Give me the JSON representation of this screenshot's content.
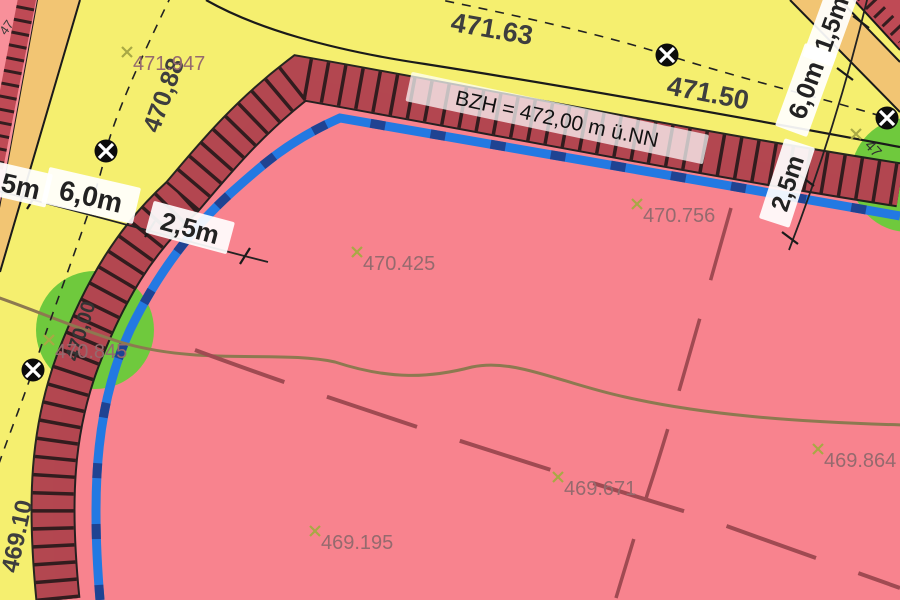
{
  "map": {
    "reference_height": "BZH = 472,00 m ü.NN",
    "road_elevation_labels": {
      "top_1": "471.63",
      "top_2": "471.50",
      "left_1": "470,88",
      "left_2": "469.10"
    },
    "contour_labels": {
      "contour_470": "470,00"
    },
    "partial_labels": {
      "top_left_corner": "47",
      "right_tree": "47"
    },
    "dimension_labels": {
      "left_15": "1,5m",
      "left_60": "6,0m",
      "left_25": "2,5m",
      "right_15": "1,5m",
      "right_60": "6,0m",
      "right_25": "2,5m"
    },
    "spot_heights": {
      "s1": "471.947",
      "s2": "470.425",
      "s3": "470.756",
      "s4": "469.195",
      "s5": "469.671",
      "s6": "469.864",
      "s7": "470.845"
    },
    "colors": {
      "road_yellow": "#f5ef6f",
      "sidewalk_orange": "#f2c573",
      "plot_red": "#f8838e",
      "plot_pink": "#f8909a",
      "boundary_darkred": "#bf4a55",
      "baugrenze_blue": "#2379e2",
      "blue_dash_dark": "#1f3d8a",
      "tree_green": "#6fc93d",
      "contour_brown": "#8d7950",
      "parcel_dashed_red": "#a04a52",
      "spot_text": "#956a6e",
      "marker_olive": "#a8a845"
    }
  }
}
